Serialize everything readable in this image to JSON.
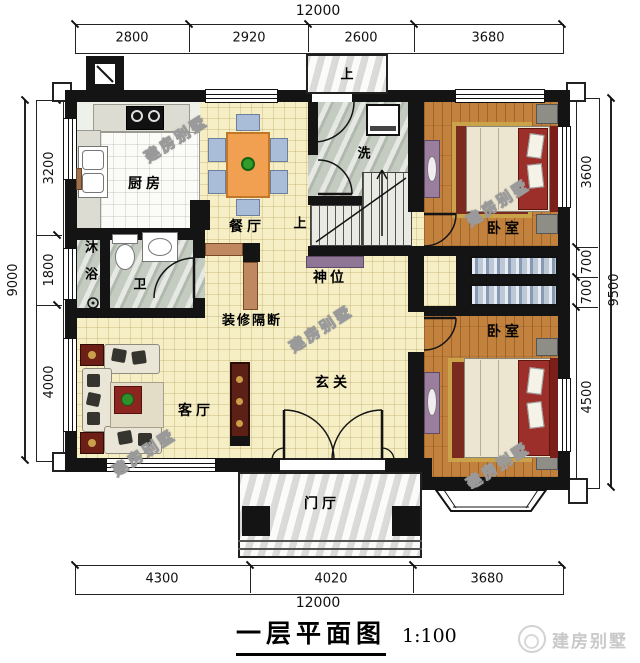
{
  "title": {
    "text": "一层平面图",
    "scale": "1:100"
  },
  "brand": {
    "text": "建房别墅"
  },
  "watermark": "建房别墅",
  "dims": {
    "top": {
      "total": "12000",
      "seg": [
        "2800",
        "2920",
        "2600",
        "3680"
      ]
    },
    "bottom": {
      "total": "12000",
      "seg": [
        "4300",
        "4020",
        "3680"
      ]
    },
    "left": {
      "total": "9000",
      "seg": [
        "3200",
        "1800",
        "4000"
      ]
    },
    "right": {
      "total": "9500",
      "seg": [
        "3600",
        "700",
        "700",
        "4500"
      ]
    }
  },
  "labels": {
    "kitchen": "厨房",
    "dining": "餐厅",
    "laundry": "洗",
    "shower": "沐浴",
    "toilet": "卫",
    "shrine": "神位",
    "partition": "装修隔断",
    "living": "客厅",
    "entry": "玄关",
    "foyer": "门厅",
    "bedroom_top": "卧室",
    "bedroom_bottom": "卧室",
    "stairs_up_outside": "上",
    "stairs_up_inside": "上",
    "ac": "AC"
  },
  "colors": {
    "wall": "#141414",
    "floor_tile": "#f6efc6",
    "wood_floor": "#c2823e",
    "table_orange": "#f0a050",
    "bed_red": "#9c2f2a",
    "furniture_purple": "#9b7d9e",
    "wardrobe_blue": "#8799b3"
  }
}
